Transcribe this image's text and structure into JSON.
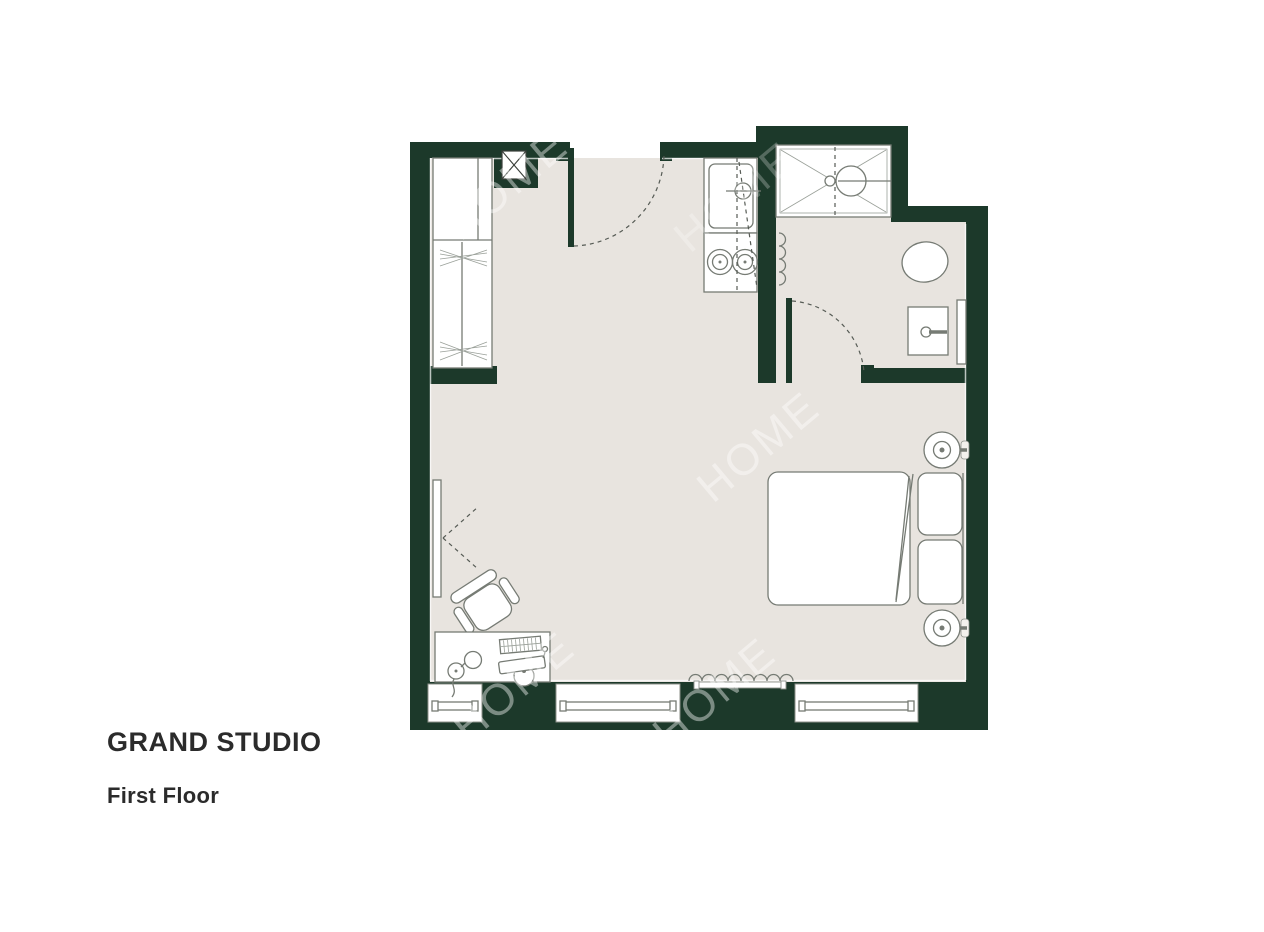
{
  "title": "GRAND STUDIO",
  "subtitle": "First Floor",
  "watermark": {
    "text": "HOME"
  },
  "colors": {
    "wall": "#1c392a",
    "floor": "#e8e4df",
    "fixture_outline": "#767b74",
    "caption_text": "#2b2b2b",
    "background": "#ffffff"
  },
  "plan": {
    "unit_name": "Grand Studio",
    "floor_label": "First Floor",
    "rooms": [
      "studio-room",
      "bathroom"
    ],
    "fixtures": [
      "wardrobe",
      "service-shaft",
      "entry-door",
      "kitchen-sink",
      "cooktop",
      "shower",
      "bathroom-door",
      "toilet",
      "washbasin",
      "mirror",
      "towel-radiator",
      "radiator",
      "double-bed",
      "pillows",
      "wall-lamp",
      "tv",
      "desk",
      "desk-chair",
      "desk-lamp",
      "monitor",
      "keyboard",
      "window"
    ],
    "window_count": 3
  }
}
